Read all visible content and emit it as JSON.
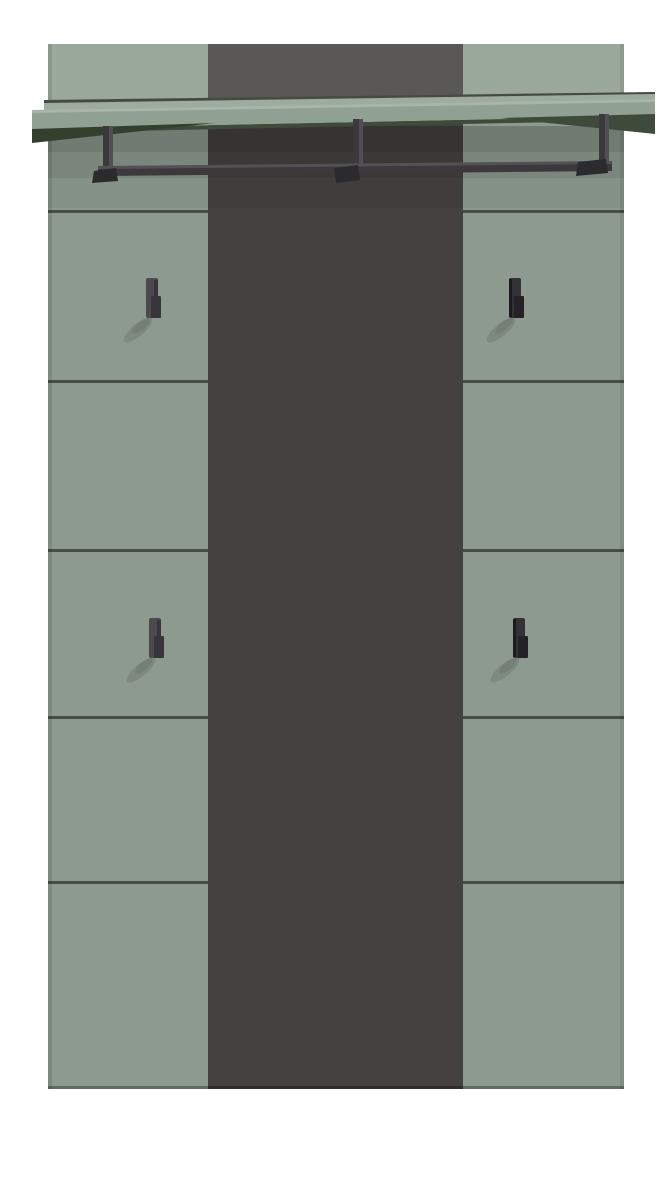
{
  "product": {
    "subject": "wall-mounted-hallway-coat-rack-panel",
    "hook_count": 4,
    "shelf_count": 1,
    "rail_count": 1,
    "rail_bracket_count": 3,
    "left_column_sections": 6,
    "right_column_sections": 6
  },
  "colors": {
    "background": "#ffffff",
    "panel": "#8D9A8F",
    "panel_top": "#9BA89C",
    "stripe": "#444140",
    "stripe_top": "#5A5757",
    "seam": "#39413A",
    "back_seam": "#454B40",
    "shelf_sliver": "#9EAB9F",
    "shelf_face": "#90A093",
    "shelf_under": "#3E4B3A",
    "shelf_under_dark": "#33402E",
    "metal": "#3B393C",
    "metal_light": "#514F53",
    "metal_dark": "#2B2A2D",
    "hook_body": "#4C4A4D",
    "hook_nub": "#38363A",
    "hook_dark": "#343237",
    "hook_dark_nub": "#242127",
    "hook_edge": "#1C1B1E",
    "highlight": "#FFFFFF",
    "shadow": "#000000"
  }
}
